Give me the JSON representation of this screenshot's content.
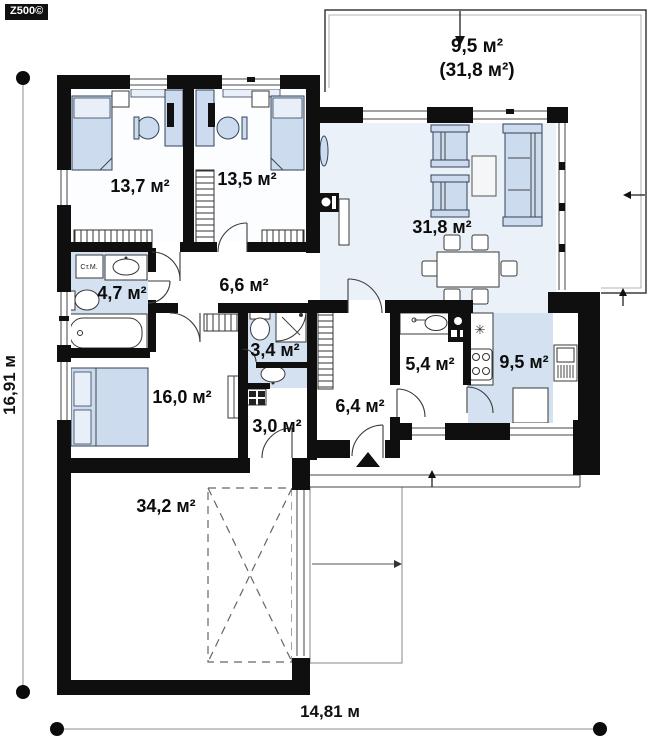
{
  "logo": {
    "text": "Z500©"
  },
  "dimensions": {
    "vertical": "16,91 м",
    "horizontal": "14,81 м"
  },
  "terrace": {
    "area": "9,5 м²",
    "area_total": "(31,8 м²)"
  },
  "rooms": [
    {
      "id": "bedroom-1",
      "area": "13,7 м²"
    },
    {
      "id": "bedroom-2",
      "area": "13,5 м²"
    },
    {
      "id": "living-room",
      "area": "31,8 м²"
    },
    {
      "id": "hallway",
      "area": "6,6 м²"
    },
    {
      "id": "bathroom-1",
      "area": "4,7 м²"
    },
    {
      "id": "bathroom-2",
      "area": "3,4 м²"
    },
    {
      "id": "bedroom-3",
      "area": "16,0 м²"
    },
    {
      "id": "utility-room",
      "area": "3,0 м²"
    },
    {
      "id": "entrance-hall",
      "area": "6,4 м²"
    },
    {
      "id": "pantry",
      "area": "5,4 м²"
    },
    {
      "id": "kitchen",
      "area": "9,5 м²"
    },
    {
      "id": "garage",
      "area": "34,2 м²"
    }
  ],
  "annotations": {
    "washing_machine": "Ст.М.",
    "hob_symbol": "✳"
  },
  "colors": {
    "wall": "#0f0f0f",
    "wet_floor": "#d3e1f0",
    "living_floor": "#ebf1f8",
    "furniture": "#ccdcee"
  }
}
